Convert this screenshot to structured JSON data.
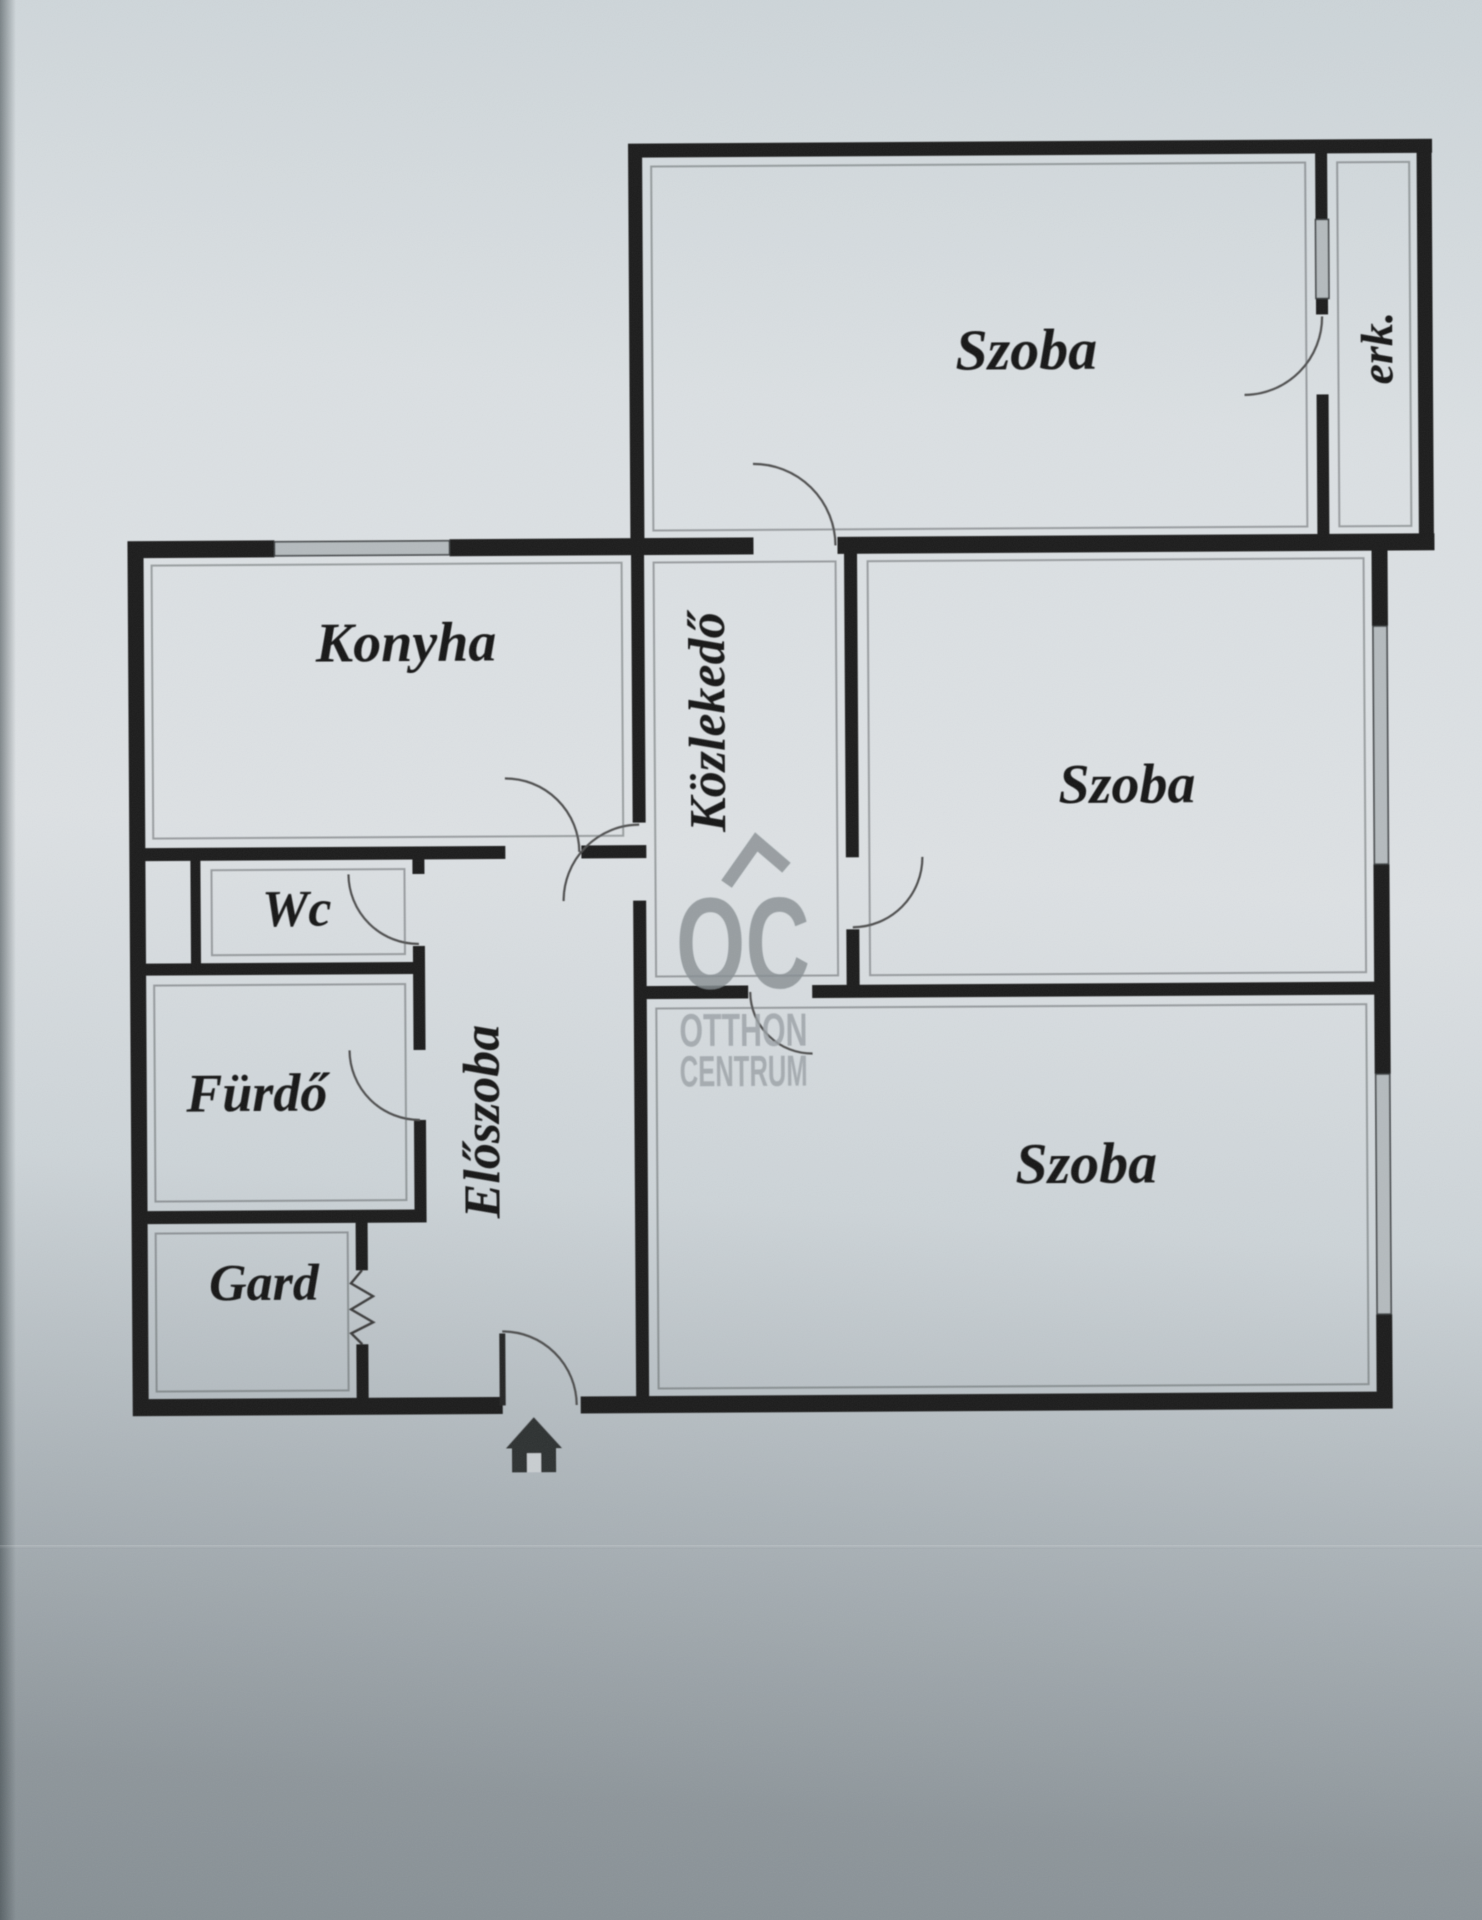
{
  "plan": {
    "rooms": {
      "szoba_top": {
        "label": "Szoba"
      },
      "szoba_middle": {
        "label": "Szoba"
      },
      "szoba_bottom": {
        "label": "Szoba"
      },
      "konyha": {
        "label": "Konyha"
      },
      "kozlekedo": {
        "label": "Közlekedő"
      },
      "eloszoba": {
        "label": "Előszoba"
      },
      "wc": {
        "label": "Wc"
      },
      "furdo": {
        "label": "Fürdő"
      },
      "gard": {
        "label": "Gard"
      },
      "balcony": {
        "label": "erk."
      }
    },
    "watermark": {
      "logo": "OC",
      "line1": "OTTHON",
      "line2": "CENTRUM"
    },
    "colors": {
      "wall": "#1d1d1d",
      "label_ink": "#161616",
      "window_gray": "#b5bbbe",
      "watermark_gray": "#878e92",
      "watermark_text_gray": "#9aa1a5",
      "paper_light": "#dbe0e3",
      "paper_dark": "#8e969b"
    }
  }
}
